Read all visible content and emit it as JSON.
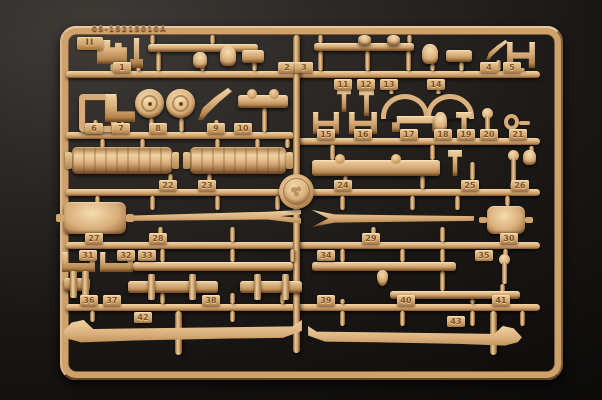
{
  "colors": {
    "background_dark": "#0c0b0a",
    "background_light": "#403c38",
    "plastic_base": "#d9ae7a",
    "plastic_highlight": "#f2d6a6",
    "plastic_shadow": "#7c4f26",
    "tag_text": "#7c5226"
  },
  "sprue": {
    "mold_code": "05-15215010A",
    "corner_mark": "II",
    "frame": {
      "x": 60,
      "y": 26,
      "w": 485,
      "h": 336,
      "border": 9
    },
    "runners": [
      [
        66,
        71,
        474
      ],
      [
        66,
        132,
        228
      ],
      [
        294,
        138,
        246
      ],
      [
        66,
        189,
        474
      ],
      [
        66,
        242,
        474
      ],
      [
        66,
        304,
        474
      ]
    ],
    "vruns": [
      [
        293,
        35,
        318
      ],
      [
        175,
        311,
        44
      ],
      [
        490,
        311,
        44
      ]
    ],
    "stubs": [
      [
        110,
        64,
        7
      ],
      [
        136,
        68,
        3
      ],
      [
        150,
        35,
        9
      ],
      [
        210,
        35,
        9
      ],
      [
        156,
        52,
        19
      ],
      [
        200,
        52,
        19
      ],
      [
        252,
        52,
        19
      ],
      [
        318,
        35,
        8
      ],
      [
        407,
        35,
        8
      ],
      [
        318,
        51,
        20
      ],
      [
        365,
        51,
        20
      ],
      [
        406,
        51,
        20
      ],
      [
        430,
        64,
        7
      ],
      [
        459,
        62,
        9
      ],
      [
        496,
        60,
        11
      ],
      [
        520,
        68,
        3
      ],
      [
        93,
        120,
        12
      ],
      [
        120,
        122,
        10
      ],
      [
        149,
        118,
        14
      ],
      [
        179,
        118,
        14
      ],
      [
        214,
        120,
        12
      ],
      [
        262,
        108,
        24
      ],
      [
        389,
        90,
        4
      ],
      [
        436,
        90,
        4
      ],
      [
        325,
        134,
        4
      ],
      [
        360,
        134,
        4
      ],
      [
        400,
        132,
        6
      ],
      [
        440,
        132,
        6
      ],
      [
        463,
        134,
        4
      ],
      [
        486,
        134,
        4
      ],
      [
        513,
        130,
        8
      ],
      [
        100,
        139,
        9
      ],
      [
        140,
        139,
        9
      ],
      [
        215,
        139,
        9
      ],
      [
        255,
        139,
        9
      ],
      [
        285,
        139,
        9
      ],
      [
        168,
        174,
        15
      ],
      [
        207,
        174,
        15
      ],
      [
        330,
        145,
        15
      ],
      [
        430,
        145,
        15
      ],
      [
        343,
        176,
        5
      ],
      [
        420,
        176,
        13
      ],
      [
        470,
        162,
        18
      ],
      [
        529,
        146,
        7
      ],
      [
        510,
        182,
        7
      ],
      [
        95,
        196,
        8
      ],
      [
        150,
        196,
        14
      ],
      [
        215,
        196,
        14
      ],
      [
        275,
        196,
        14
      ],
      [
        340,
        196,
        14
      ],
      [
        410,
        196,
        14
      ],
      [
        455,
        196,
        14
      ],
      [
        505,
        196,
        10
      ],
      [
        94,
        228,
        14
      ],
      [
        158,
        227,
        15
      ],
      [
        230,
        227,
        15
      ],
      [
        371,
        227,
        15
      ],
      [
        440,
        227,
        15
      ],
      [
        509,
        234,
        8
      ],
      [
        160,
        249,
        13
      ],
      [
        230,
        249,
        13
      ],
      [
        290,
        249,
        13
      ],
      [
        340,
        249,
        13
      ],
      [
        400,
        249,
        13
      ],
      [
        440,
        249,
        13
      ],
      [
        503,
        249,
        7
      ],
      [
        80,
        294,
        10
      ],
      [
        160,
        293,
        11
      ],
      [
        230,
        293,
        11
      ],
      [
        280,
        293,
        11
      ],
      [
        340,
        299,
        5
      ],
      [
        406,
        299,
        5
      ],
      [
        470,
        299,
        5
      ],
      [
        500,
        284,
        20
      ],
      [
        440,
        271,
        20
      ],
      [
        90,
        311,
        11
      ],
      [
        230,
        311,
        11
      ],
      [
        340,
        311,
        15
      ],
      [
        400,
        311,
        15
      ],
      [
        470,
        311,
        15
      ],
      [
        520,
        311,
        15
      ]
    ],
    "tags": [
      {
        "n": "1",
        "x": 122,
        "y": 62
      },
      {
        "n": "2",
        "x": 287,
        "y": 62
      },
      {
        "n": "3",
        "x": 304,
        "y": 62
      },
      {
        "n": "4",
        "x": 489,
        "y": 62
      },
      {
        "n": "5",
        "x": 512,
        "y": 62
      },
      {
        "n": "6",
        "x": 94,
        "y": 123
      },
      {
        "n": "7",
        "x": 121,
        "y": 123
      },
      {
        "n": "8",
        "x": 158,
        "y": 123
      },
      {
        "n": "9",
        "x": 216,
        "y": 123
      },
      {
        "n": "10",
        "x": 243,
        "y": 123
      },
      {
        "n": "11",
        "x": 343,
        "y": 79
      },
      {
        "n": "12",
        "x": 366,
        "y": 79
      },
      {
        "n": "13",
        "x": 389,
        "y": 79
      },
      {
        "n": "14",
        "x": 436,
        "y": 79
      },
      {
        "n": "15",
        "x": 326,
        "y": 129
      },
      {
        "n": "16",
        "x": 363,
        "y": 129
      },
      {
        "n": "17",
        "x": 409,
        "y": 129
      },
      {
        "n": "18",
        "x": 443,
        "y": 129
      },
      {
        "n": "19",
        "x": 466,
        "y": 129
      },
      {
        "n": "20",
        "x": 489,
        "y": 129
      },
      {
        "n": "21",
        "x": 518,
        "y": 129
      },
      {
        "n": "22",
        "x": 168,
        "y": 180
      },
      {
        "n": "23",
        "x": 207,
        "y": 180
      },
      {
        "n": "24",
        "x": 343,
        "y": 180
      },
      {
        "n": "25",
        "x": 470,
        "y": 180
      },
      {
        "n": "26",
        "x": 520,
        "y": 180
      },
      {
        "n": "27",
        "x": 94,
        "y": 233
      },
      {
        "n": "28",
        "x": 158,
        "y": 233
      },
      {
        "n": "29",
        "x": 371,
        "y": 233
      },
      {
        "n": "30",
        "x": 509,
        "y": 233
      },
      {
        "n": "31",
        "x": 88,
        "y": 250
      },
      {
        "n": "32",
        "x": 126,
        "y": 250
      },
      {
        "n": "33",
        "x": 147,
        "y": 250
      },
      {
        "n": "34",
        "x": 326,
        "y": 250
      },
      {
        "n": "35",
        "x": 484,
        "y": 250
      },
      {
        "n": "36",
        "x": 89,
        "y": 295
      },
      {
        "n": "37",
        "x": 112,
        "y": 295
      },
      {
        "n": "38",
        "x": 211,
        "y": 295
      },
      {
        "n": "39",
        "x": 326,
        "y": 295
      },
      {
        "n": "40",
        "x": 406,
        "y": 295
      },
      {
        "n": "41",
        "x": 501,
        "y": 295
      },
      {
        "n": "42",
        "x": 143,
        "y": 312
      },
      {
        "n": "43",
        "x": 456,
        "y": 316
      }
    ],
    "parts": [
      {
        "t": "bracket",
        "x": 97,
        "y": 40,
        "w": 30,
        "h": 24
      },
      {
        "t": "lpost",
        "x": 130,
        "y": 38,
        "w": 13,
        "h": 30
      },
      {
        "t": "bar",
        "x": 148,
        "y": 44,
        "w": 110,
        "h": 8
      },
      {
        "t": "knob",
        "x": 193,
        "y": 52,
        "w": 14,
        "h": 16
      },
      {
        "t": "knob",
        "x": 220,
        "y": 46,
        "w": 16,
        "h": 20
      },
      {
        "t": "assembly",
        "x": 242,
        "y": 50,
        "w": 22,
        "h": 13
      },
      {
        "t": "bar",
        "x": 314,
        "y": 43,
        "w": 100,
        "h": 8
      },
      {
        "t": "knob",
        "x": 358,
        "y": 35,
        "w": 13,
        "h": 10
      },
      {
        "t": "knob",
        "x": 387,
        "y": 35,
        "w": 13,
        "h": 10
      },
      {
        "t": "knob",
        "x": 422,
        "y": 44,
        "w": 16,
        "h": 20
      },
      {
        "t": "assembly",
        "x": 446,
        "y": 50,
        "w": 26,
        "h": 12
      },
      {
        "t": "lever",
        "x": 486,
        "y": 40,
        "w": 22,
        "h": 20
      },
      {
        "t": "hbracket",
        "x": 507,
        "y": 42,
        "w": 28,
        "h": 26
      },
      {
        "t": "sqframe",
        "x": 79,
        "y": 94,
        "w": 26,
        "h": 26
      },
      {
        "t": "angle",
        "x": 105,
        "y": 94,
        "w": 30,
        "h": 28
      },
      {
        "t": "disc",
        "x": 135,
        "y": 89,
        "w": 29,
        "h": 29
      },
      {
        "t": "disc",
        "x": 166,
        "y": 89,
        "w": 29,
        "h": 29
      },
      {
        "t": "lever",
        "x": 198,
        "y": 88,
        "w": 34,
        "h": 32
      },
      {
        "t": "linkage",
        "x": 238,
        "y": 95,
        "w": 50,
        "h": 13
      },
      {
        "t": "tpart",
        "x": 337,
        "y": 88,
        "w": 14,
        "h": 24
      },
      {
        "t": "tpart",
        "x": 359,
        "y": 88,
        "w": 15,
        "h": 28
      },
      {
        "t": "ubar",
        "x": 381,
        "y": 94,
        "w": 38,
        "h": 20
      },
      {
        "t": "ubar",
        "x": 426,
        "y": 94,
        "w": 38,
        "h": 20
      },
      {
        "t": "hclamp",
        "x": 313,
        "y": 112,
        "w": 26,
        "h": 22
      },
      {
        "t": "hclamp",
        "x": 349,
        "y": 112,
        "w": 28,
        "h": 22
      },
      {
        "t": "spreader",
        "x": 392,
        "y": 116,
        "w": 48,
        "h": 16
      },
      {
        "t": "knob",
        "x": 434,
        "y": 112,
        "w": 13,
        "h": 20
      },
      {
        "t": "tpart",
        "x": 456,
        "y": 112,
        "w": 16,
        "h": 22
      },
      {
        "t": "balllever",
        "x": 481,
        "y": 110,
        "w": 12,
        "h": 24
      },
      {
        "t": "ringpin",
        "x": 504,
        "y": 114,
        "w": 26,
        "h": 16
      },
      {
        "t": "cylinder",
        "x": 72,
        "y": 147,
        "w": 100,
        "h": 27
      },
      {
        "t": "cylinder",
        "x": 190,
        "y": 147,
        "w": 96,
        "h": 27
      },
      {
        "t": "linkage",
        "x": 312,
        "y": 160,
        "w": 128,
        "h": 16
      },
      {
        "t": "tpart",
        "x": 448,
        "y": 150,
        "w": 14,
        "h": 26
      },
      {
        "t": "balllever",
        "x": 505,
        "y": 152,
        "w": 16,
        "h": 30
      },
      {
        "t": "knob",
        "x": 523,
        "y": 150,
        "w": 13,
        "h": 15
      },
      {
        "t": "barrel",
        "x": 64,
        "y": 202,
        "w": 62,
        "h": 32
      },
      {
        "t": "beam-taper",
        "x": 133,
        "y": 210,
        "w": 168,
        "h": 17
      },
      {
        "t": "beam-fork",
        "x": 312,
        "y": 210,
        "w": 162,
        "h": 17
      },
      {
        "t": "barrel",
        "x": 487,
        "y": 206,
        "w": 38,
        "h": 28
      },
      {
        "t": "towhook",
        "x": 62,
        "y": 252,
        "w": 33,
        "h": 20
      },
      {
        "t": "towhook",
        "x": 100,
        "y": 252,
        "w": 33,
        "h": 20
      },
      {
        "t": "bar",
        "x": 133,
        "y": 262,
        "w": 160,
        "h": 9
      },
      {
        "t": "axle",
        "x": 64,
        "y": 278,
        "w": 26,
        "h": 13
      },
      {
        "t": "axle",
        "x": 128,
        "y": 281,
        "w": 90,
        "h": 12
      },
      {
        "t": "axle",
        "x": 240,
        "y": 281,
        "w": 62,
        "h": 12
      },
      {
        "t": "bar",
        "x": 312,
        "y": 262,
        "w": 144,
        "h": 9
      },
      {
        "t": "droplet",
        "x": 377,
        "y": 270,
        "w": 11,
        "h": 16
      },
      {
        "t": "balllever",
        "x": 497,
        "y": 256,
        "w": 14,
        "h": 28
      },
      {
        "t": "bar",
        "x": 390,
        "y": 291,
        "w": 130,
        "h": 8
      },
      {
        "t": "rail",
        "x": 62,
        "y": 320,
        "w": 240,
        "h": 32
      },
      {
        "t": "rail",
        "x": 308,
        "y": 326,
        "w": 214,
        "h": 28,
        "f": 1
      }
    ],
    "medallion": {
      "x": 296,
      "y": 191,
      "r": 17
    }
  }
}
